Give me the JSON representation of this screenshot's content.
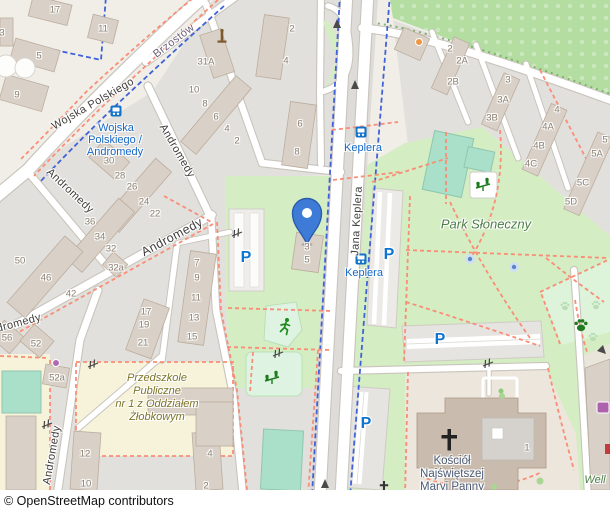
{
  "attribution": "© OpenStreetMap contributors",
  "colors": {
    "land": "#f1eee8",
    "residential": "#e2e0dc",
    "grass": "#d4edc3",
    "orchard": "#b4dda2",
    "pitch": "#aadfc9",
    "mint": "#dff3e2",
    "dogpark": "#ddf3da",
    "school": "#f6f3da",
    "church_ground": "#ece6dc",
    "building": "#d9d0c7",
    "building_stroke": "#bcae9e",
    "church_building": "#c9bcae",
    "road": "#ffffff",
    "casing": "#c9c4bc",
    "footway": "#fa8d76",
    "cycleway": "#4062d8",
    "transit": "#1272c8",
    "parking": "#0d74cf",
    "marker": "#3e7bd6",
    "marker_stroke": "#2b5cad"
  },
  "marker": {
    "name": "location-pin",
    "x": 307,
    "y": 244
  },
  "streets": [
    {
      "t": "Wojska Polskiego",
      "x": 93,
      "y": 104,
      "r": -30
    },
    {
      "t": "Brzostów",
      "x": 174,
      "y": 41,
      "r": -37,
      "cls": "minor"
    },
    {
      "t": "Andromedy",
      "x": 177,
      "y": 151,
      "r": 60
    },
    {
      "t": "Andromedy",
      "x": 70,
      "y": 191,
      "r": 43
    },
    {
      "t": "Andromedy",
      "x": 172,
      "y": 237,
      "r": -28,
      "cls": "big"
    },
    {
      "t": "Andromedy",
      "x": 12,
      "y": 325,
      "r": -15
    },
    {
      "t": "Andromedy",
      "x": 52,
      "y": 455,
      "r": -80
    },
    {
      "t": "Jana Keplera",
      "x": 357,
      "y": 221,
      "r": -87
    }
  ],
  "transit_stops": [
    {
      "icon": {
        "x": 116,
        "y": 111
      },
      "lines": [
        {
          "t": "Wojska",
          "x": 116,
          "y": 128
        },
        {
          "t": "Polskiego /",
          "x": 115,
          "y": 140
        },
        {
          "t": "Andromedy",
          "x": 115,
          "y": 152
        }
      ]
    },
    {
      "icon": {
        "x": 361,
        "y": 132
      },
      "lines": [
        {
          "t": "Keplera",
          "x": 363,
          "y": 148
        }
      ]
    },
    {
      "icon": {
        "x": 361,
        "y": 259
      },
      "lines": [
        {
          "t": "Keplera",
          "x": 364,
          "y": 273
        }
      ]
    }
  ],
  "parking_icons": [
    {
      "t": "P",
      "x": 246,
      "y": 258
    },
    {
      "t": "P",
      "x": 389,
      "y": 255
    },
    {
      "t": "P",
      "x": 440,
      "y": 340
    },
    {
      "t": "P",
      "x": 366,
      "y": 424
    }
  ],
  "places": [
    {
      "t": "Park Słoneczny",
      "x": 486,
      "y": 224,
      "cls": "park-name"
    },
    {
      "t": "Well",
      "x": 595,
      "y": 480,
      "cls": "well-name"
    },
    {
      "t": "Przedszkole",
      "x": 157,
      "y": 378,
      "cls": "school-name"
    },
    {
      "t": "Publiczne",
      "x": 157,
      "y": 391,
      "cls": "school-name"
    },
    {
      "t": "nr 1 z Oddziałem",
      "x": 157,
      "y": 404,
      "cls": "school-name"
    },
    {
      "t": "Żłobkowym",
      "x": 157,
      "y": 417,
      "cls": "school-name"
    },
    {
      "t": "Kościół",
      "x": 452,
      "y": 461,
      "cls": "church-name"
    },
    {
      "t": "Najświętszej",
      "x": 452,
      "y": 474,
      "cls": "church-name"
    },
    {
      "t": "Maryi Panny",
      "x": 452,
      "y": 487,
      "cls": "church-name"
    },
    {
      "t": "Królowej",
      "x": 452,
      "y": 499,
      "cls": "church-name"
    }
  ],
  "housenumbers": [
    [
      "3",
      2,
      33
    ],
    [
      "17",
      55,
      10
    ],
    [
      "11",
      103,
      29
    ],
    [
      "5",
      39,
      56
    ],
    [
      "9",
      17,
      95
    ],
    [
      "30",
      109,
      161
    ],
    [
      "31A",
      206,
      62
    ],
    [
      "2",
      292,
      29
    ],
    [
      "4",
      286,
      61
    ],
    [
      "6",
      300,
      124
    ],
    [
      "8",
      297,
      152
    ],
    [
      "10",
      194,
      90
    ],
    [
      "8",
      205,
      104
    ],
    [
      "6",
      216,
      117
    ],
    [
      "4",
      227,
      129
    ],
    [
      "2",
      237,
      141
    ],
    [
      "28",
      120,
      176
    ],
    [
      "26",
      132,
      187
    ],
    [
      "24",
      144,
      202
    ],
    [
      "22",
      155,
      214
    ],
    [
      "36",
      90,
      222
    ],
    [
      "34",
      100,
      237
    ],
    [
      "32",
      111,
      249
    ],
    [
      "32a",
      116,
      268
    ],
    [
      "50",
      20,
      261
    ],
    [
      "46",
      46,
      278
    ],
    [
      "42",
      71,
      294
    ],
    [
      "56",
      7,
      338
    ],
    [
      "52",
      36,
      344
    ],
    [
      "52a",
      57,
      378
    ],
    [
      "7",
      197,
      263
    ],
    [
      "9",
      197,
      278
    ],
    [
      "11",
      196,
      298
    ],
    [
      "13",
      194,
      318
    ],
    [
      "15",
      192,
      337
    ],
    [
      "17",
      146,
      312
    ],
    [
      "19",
      144,
      325
    ],
    [
      "21",
      143,
      343
    ],
    [
      "3",
      307,
      247
    ],
    [
      "5",
      307,
      260
    ],
    [
      "12",
      85,
      454
    ],
    [
      "10",
      86,
      484
    ],
    [
      "4",
      210,
      454
    ],
    [
      "2",
      206,
      486
    ],
    [
      "2",
      450,
      49
    ],
    [
      "2A",
      462,
      61
    ],
    [
      "2B",
      453,
      82
    ],
    [
      "3",
      508,
      80
    ],
    [
      "3A",
      503,
      100
    ],
    [
      "3B",
      492,
      118
    ],
    [
      "4",
      557,
      110
    ],
    [
      "4A",
      548,
      127
    ],
    [
      "4B",
      539,
      146
    ],
    [
      "4C",
      531,
      164
    ],
    [
      "5",
      605,
      140
    ],
    [
      "5A",
      597,
      154
    ],
    [
      "5C",
      583,
      183
    ],
    [
      "5D",
      571,
      202
    ],
    [
      "1",
      527,
      448
    ]
  ]
}
